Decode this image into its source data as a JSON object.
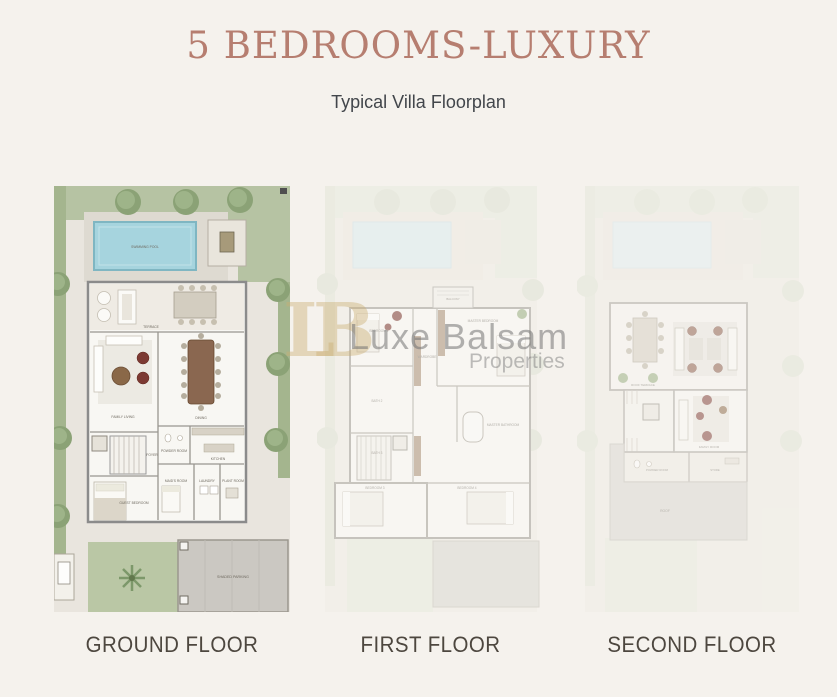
{
  "page": {
    "background_color": "#f5f2ed"
  },
  "header": {
    "title": "5 BEDROOMS-LUXURY",
    "subtitle": "Typical Villa Floorplan",
    "title_color": "#b67e70"
  },
  "watermark": {
    "monogram": "LB",
    "name": "Luxe Balsam",
    "tagline": "Properties"
  },
  "floors": [
    {
      "label": "GROUND FLOOR",
      "rooms": [
        "SWIMMING POOL",
        "TERRACE",
        "FAMILY LIVING",
        "DINING",
        "KITCHEN",
        "POWDER ROOM",
        "MAID'S ROOM",
        "LAUNDRY",
        "PLANT ROOM",
        "GUEST BEDROOM",
        "FOYER",
        "SHADED PARKING"
      ]
    },
    {
      "label": "FIRST FLOOR",
      "rooms": [
        "MASTER BEDROOM",
        "MASTER BATHROOM",
        "WARDROBE",
        "BEDROOM 2",
        "BATH 2",
        "BEDROOM 3",
        "BATH 3",
        "BEDROOM 4",
        "BALCONY"
      ]
    },
    {
      "label": "SECOND FLOOR",
      "rooms": [
        "ROOF TERRACE",
        "FAMILY ROOM",
        "POWDER ROOM",
        "STORE",
        "ROOF"
      ]
    }
  ],
  "colors": {
    "garden_green": "#b6c3a3",
    "hedge_green": "#a4b58e",
    "pool_blue": "#a6d4de",
    "hardscape": "#e9e5de",
    "parking_gray": "#cbc8c2",
    "wall_gray": "#8b8b8b",
    "wood_brown": "#8a6750",
    "accent_red": "#7c3a33",
    "watermark_gold": "#cbaf73"
  }
}
